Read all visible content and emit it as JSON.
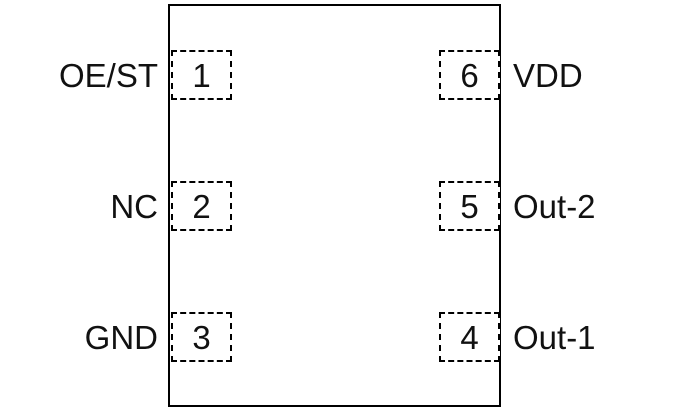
{
  "diagram": {
    "kind": "ic-pinout",
    "colors": {
      "line": "#000000",
      "background": "#ffffff",
      "text": "#111111"
    },
    "pins": {
      "left": [
        {
          "number": "1",
          "label": "OE/ST"
        },
        {
          "number": "2",
          "label": "NC"
        },
        {
          "number": "3",
          "label": "GND"
        }
      ],
      "right": [
        {
          "number": "6",
          "label": "VDD"
        },
        {
          "number": "5",
          "label": "Out-2"
        },
        {
          "number": "4",
          "label": "Out-1"
        }
      ]
    }
  }
}
